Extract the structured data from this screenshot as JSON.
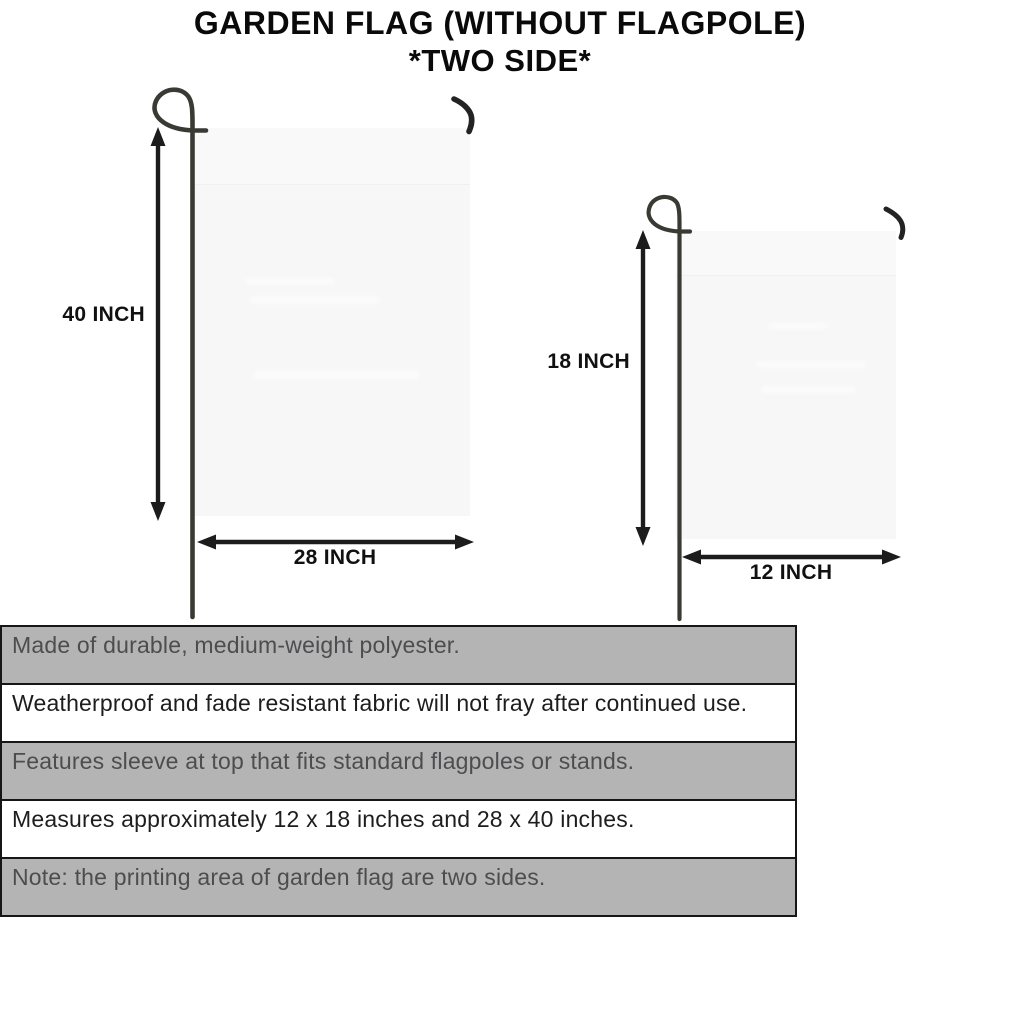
{
  "title": {
    "line1": "GARDEN FLAG (WITHOUT FLAGPOLE)",
    "line2": "*TWO SIDE*"
  },
  "diagram": {
    "large_flag": {
      "height_label": "40 INCH",
      "width_label": "28 INCH"
    },
    "small_flag": {
      "height_label": "18 INCH",
      "width_label": "12 INCH"
    }
  },
  "features": {
    "rows": [
      "Made of durable, medium-weight polyester.",
      "Weatherproof and fade resistant fabric will not fray after continued use.",
      "Features sleeve at top that fits standard flagpoles or stands.",
      "Measures approximately 12 x 18 inches and 28 x 40 inches.",
      "Note: the printing area of garden flag are two sides."
    ]
  },
  "colors": {
    "row_gray": "#b4b4b4",
    "row_white": "#ffffff",
    "flag_fill": "#f7f7f8",
    "pole": "#3a3a34",
    "arrow": "#1c1c1c",
    "table_border": "#161616"
  }
}
